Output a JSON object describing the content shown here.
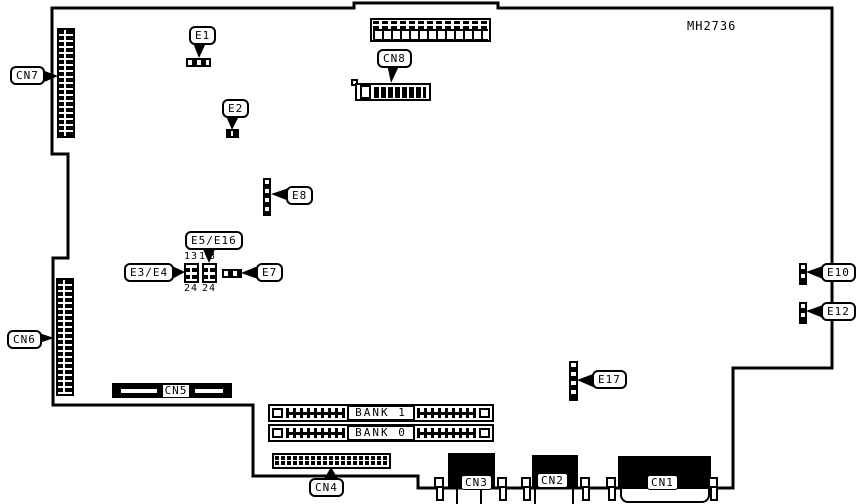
{
  "title": "MH2736",
  "callouts": {
    "cn7": "CN7",
    "cn6": "CN6",
    "cn8": "CN8",
    "cn4": "CN4",
    "e1": "E1",
    "e2": "E2",
    "e8": "E8",
    "e3_e4": "E3/E4",
    "e5_e16": "E5/E16",
    "e7": "E7",
    "e10": "E10",
    "e12": "E12",
    "e17": "E17"
  },
  "embedded_labels": {
    "cn5": "CN5",
    "cn3": "CN3",
    "cn2": "CN2",
    "cn1": "CN1",
    "bank1": "BANK 1",
    "bank0": "BANK 0"
  },
  "pin_numbers": {
    "e3_e4": {
      "top": "13",
      "bottom": "24"
    },
    "e5_e16": {
      "top": "13",
      "bottom": "24"
    }
  },
  "colors": {
    "line": "#000000",
    "background": "#ffffff"
  }
}
